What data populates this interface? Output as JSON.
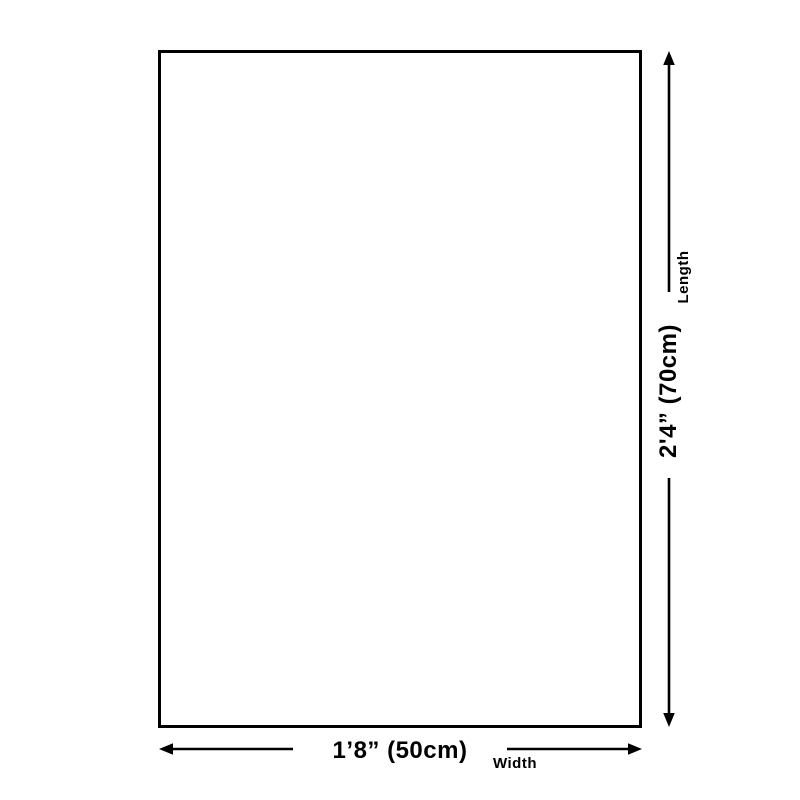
{
  "diagram": {
    "type": "product-size-dimension-diagram",
    "background_color": "#ffffff",
    "outline_color": "#000000",
    "text_color": "#000000",
    "shape": "rectangle",
    "width_dimension": {
      "value": "1’8” (50cm)",
      "axis_label": "Width"
    },
    "length_dimension": {
      "value": "2'4” (70cm)",
      "axis_label": "Length"
    }
  }
}
